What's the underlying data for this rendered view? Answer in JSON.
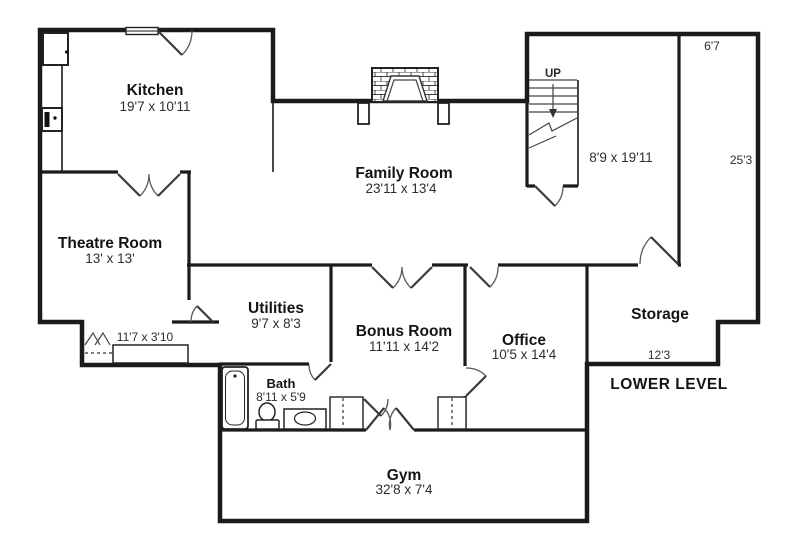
{
  "floorplan": {
    "level_label": "LOWER LEVEL",
    "rooms": {
      "kitchen": {
        "name": "Kitchen",
        "dims": "19'7 x 10'11"
      },
      "family_room": {
        "name": "Family Room",
        "dims": "23'11 x 13'4"
      },
      "theatre_room": {
        "name": "Theatre Room",
        "dims": "13' x 13'"
      },
      "utilities": {
        "name": "Utilities",
        "dims": "9'7 x 8'3"
      },
      "bonus_room": {
        "name": "Bonus Room",
        "dims": "11'11 x 14'2"
      },
      "office": {
        "name": "Office",
        "dims": "10'5 x 14'4"
      },
      "storage": {
        "name": "Storage"
      },
      "bath": {
        "name": "Bath",
        "dims": "8'11 x 5'9"
      },
      "gym": {
        "name": "Gym",
        "dims": "32'8 x 7'4"
      },
      "stair_hall": {
        "dims": "8'9 x 19'11"
      }
    },
    "dimensions": {
      "storage_width_top": "6'7",
      "storage_height_right": "25'3",
      "storage_width_bottom": "12'3",
      "closet": "11'7 x 3'10"
    },
    "stairs": {
      "direction_label": "UP"
    },
    "colors": {
      "wall": "#1b1b1b",
      "background": "#ffffff"
    }
  }
}
